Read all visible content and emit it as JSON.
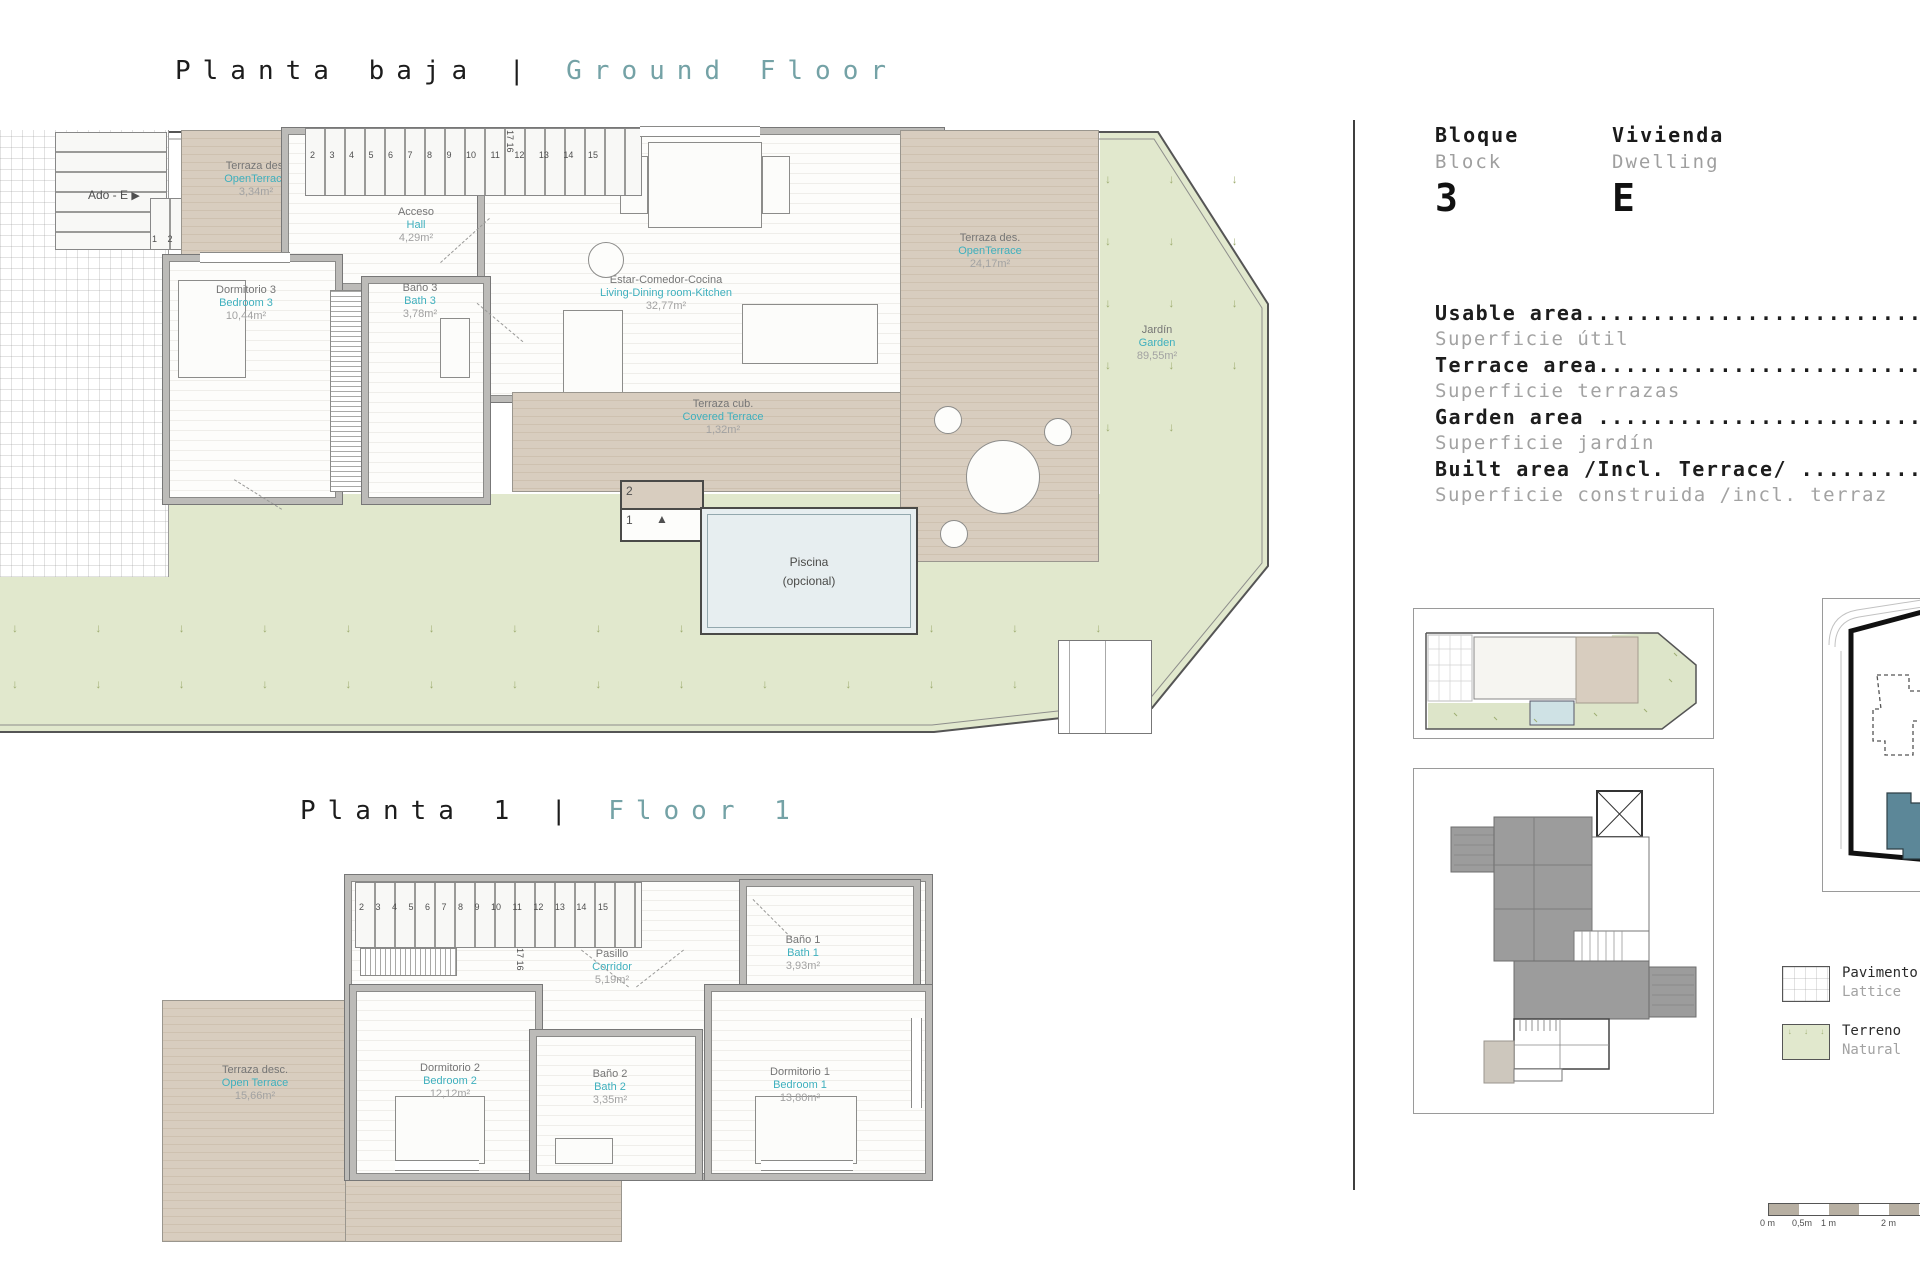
{
  "titles": {
    "ground_es": "Planta baja",
    "ground_sep": "|",
    "ground_en": "Ground Floor",
    "floor1_es": "Planta 1",
    "floor1_sep": "|",
    "floor1_en": "Floor 1"
  },
  "colors": {
    "room_label_teal": "#3FB0BE",
    "title_teal": "#74A2A6",
    "deck_tan": "#D8CDBF",
    "garden_green": "#E1E8CD",
    "pool_blue": "#E7EEF0",
    "site_highlight_teal": "#5C8798"
  },
  "gf": {
    "terrace_top": {
      "es": "Terraza des.",
      "en": "OpenTerrace",
      "area": "3,34m²"
    },
    "hall": {
      "es": "Acceso",
      "en": "Hall",
      "area": "4,29m²"
    },
    "bedroom3": {
      "es": "Dormitorio 3",
      "en": "Bedroom 3",
      "area": "10,44m²"
    },
    "bath3": {
      "es": "Baño 3",
      "en": "Bath 3",
      "area": "3,78m²"
    },
    "living": {
      "es": "Estar-Comedor-Cocina",
      "en": "Living-Dining room-Kitchen",
      "area": "32,77m²"
    },
    "covered": {
      "es": "Terraza cub.",
      "en": "Covered Terrace",
      "area": "1,32m²"
    },
    "terrace_right": {
      "es": "Terraza des.",
      "en": "OpenTerrace",
      "area": "24,17m²"
    },
    "garden": {
      "es": "Jardín",
      "en": "Garden",
      "area": "89,55m²"
    },
    "pool1": "Piscina",
    "pool2": "(opcional)",
    "ado": "Ado - E",
    "stairs_top": "2 3 4 5 6 7 8 9 10 11 12 13 14 15",
    "stairs_vert": "17 16",
    "stairs_run": "1 2 3 4 5",
    "step2": "2",
    "step1": "1"
  },
  "f1": {
    "terrace": {
      "es": "Terraza desc.",
      "en": "Open Terrace",
      "area": "15,66m²"
    },
    "corridor": {
      "es": "Pasillo",
      "en": "Corridor",
      "area": "5,19m²"
    },
    "bath1": {
      "es": "Baño 1",
      "en": "Bath 1",
      "area": "3,93m²"
    },
    "bedroom2": {
      "es": "Dormitorio 2",
      "en": "Bedroom 2",
      "area": "12,12m²"
    },
    "bath2": {
      "es": "Baño 2",
      "en": "Bath 2",
      "area": "3,35m²"
    },
    "bedroom1": {
      "es": "Dormitorio 1",
      "en": "Bedroom 1",
      "area": "13,80m²"
    },
    "stairs_top": "2 3 4 5 6 7 8 9 10 11 12 13 14 15",
    "stairs_vert": "17 16"
  },
  "panel": {
    "block_es": "Bloque",
    "block_en": "Block",
    "block_value": "3",
    "dwelling_es": "Vivienda",
    "dwelling_en": "Dwelling",
    "dwelling_value": "E",
    "area_rows": [
      {
        "en": "Usable area.............................",
        "es": "Superficie útil"
      },
      {
        "en": "Terrace area............................",
        "es": "Superficie terrazas"
      },
      {
        "en": "Garden area ............................",
        "es": "Superficie jardín"
      },
      {
        "en": "Built area /Incl. Terrace/ .............",
        "es": "Superficie construida /incl. terraz"
      }
    ],
    "legend": [
      {
        "name": "Pavimento",
        "sub": "Lattice"
      },
      {
        "name": "Terreno",
        "sub": "Natural"
      }
    ],
    "scalebar": {
      "l0": "0 m",
      "l1": "0,5m",
      "l2": "1 m",
      "l3": "2 m"
    }
  },
  "icons": {
    "triangle_right": "▶",
    "triangle_up": "▲"
  }
}
